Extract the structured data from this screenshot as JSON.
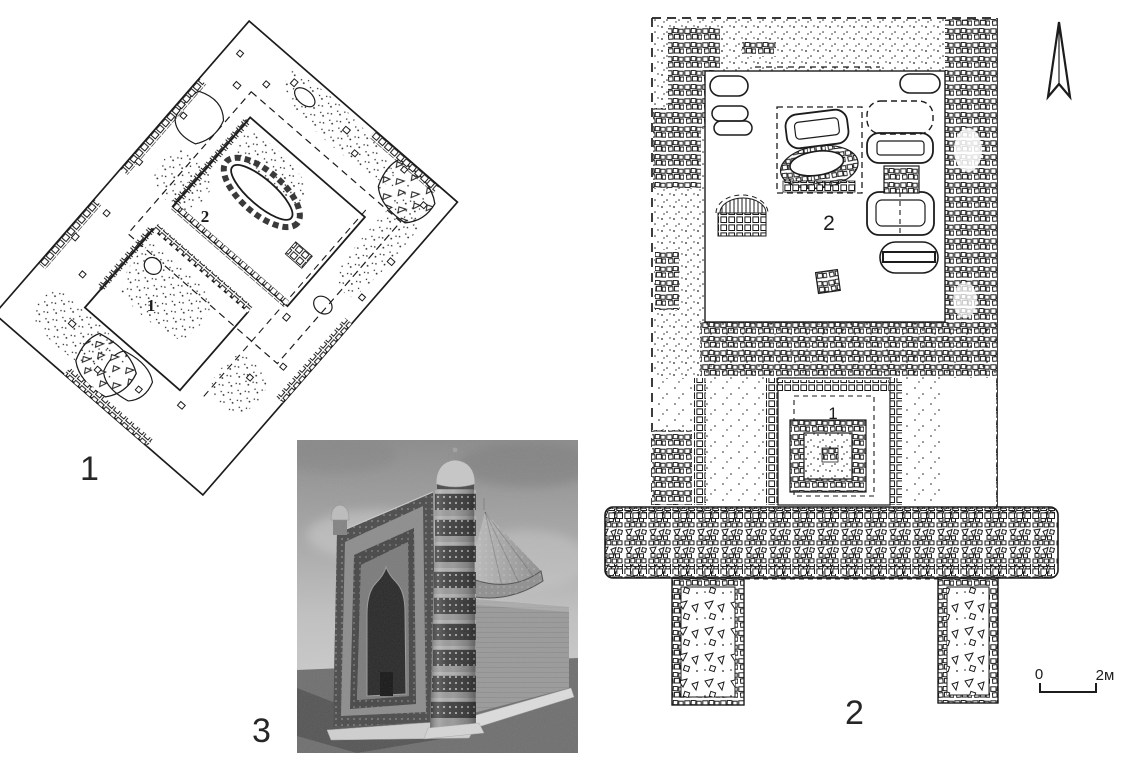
{
  "figure": {
    "paper_color": "#ffffff",
    "ink_color": "#1c1c1c"
  },
  "panels": {
    "plan1": {
      "panel_label": "1",
      "room1_label": "1",
      "room2_label": "2"
    },
    "plan2": {
      "panel_label": "2",
      "structure1_label": "1",
      "courtyard_label": "2",
      "scale_bar": {
        "zero": "0",
        "max": "2м"
      },
      "north_arrow_icon": "north-arrow-icon"
    },
    "render3": {
      "panel_label": "3"
    }
  },
  "photo_palette": {
    "sky_top": "#8a8a8a",
    "sky_bottom": "#c9c9c9",
    "ground": "#6e6e6e",
    "wall": "#999999",
    "facade": "#8c8c8c",
    "ornament_dark": "#4a4a4a",
    "arch_interior": "#282828",
    "plinth": "#dcdcdc"
  }
}
